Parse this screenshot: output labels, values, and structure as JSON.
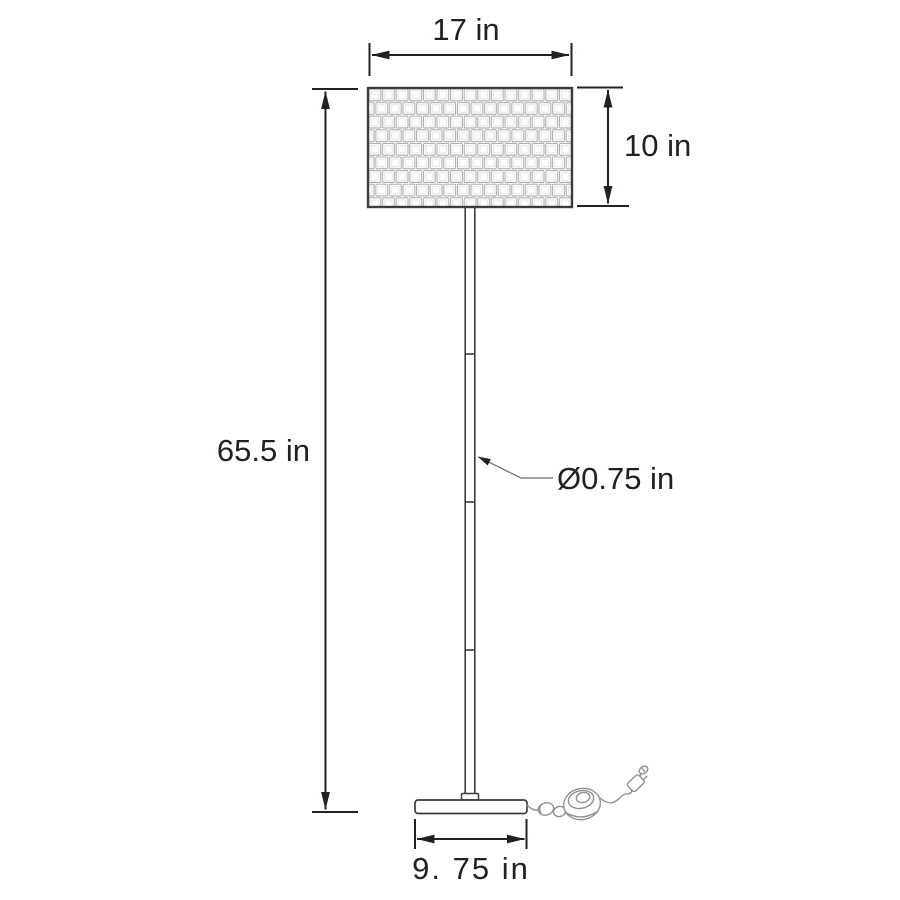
{
  "diagram": {
    "type": "product-dimension-diagram",
    "subject": "floor lamp with woven drum shade, segmented pole, oval base, foot switch and plug",
    "labels": {
      "shade_width": "17 in",
      "shade_height": "10 in",
      "overall_height": "65.5 in",
      "pole_diameter": "Ø0.75 in",
      "base_width": "9. 75 in"
    },
    "parts": {
      "shade": "woven-drum-shade",
      "pole": "lamp-pole",
      "base": "lamp-base",
      "switch": "foot-switch",
      "plug": "power-plug",
      "cord": "power-cord"
    },
    "colors": {
      "background": "#ffffff",
      "dimension": "#242021",
      "leader": "#6a6a6a",
      "outline": "#3d3d3d",
      "cord": "#8f9092",
      "weave_line": "#a9a9a9",
      "weave_inner": "#e4e4e4"
    }
  }
}
